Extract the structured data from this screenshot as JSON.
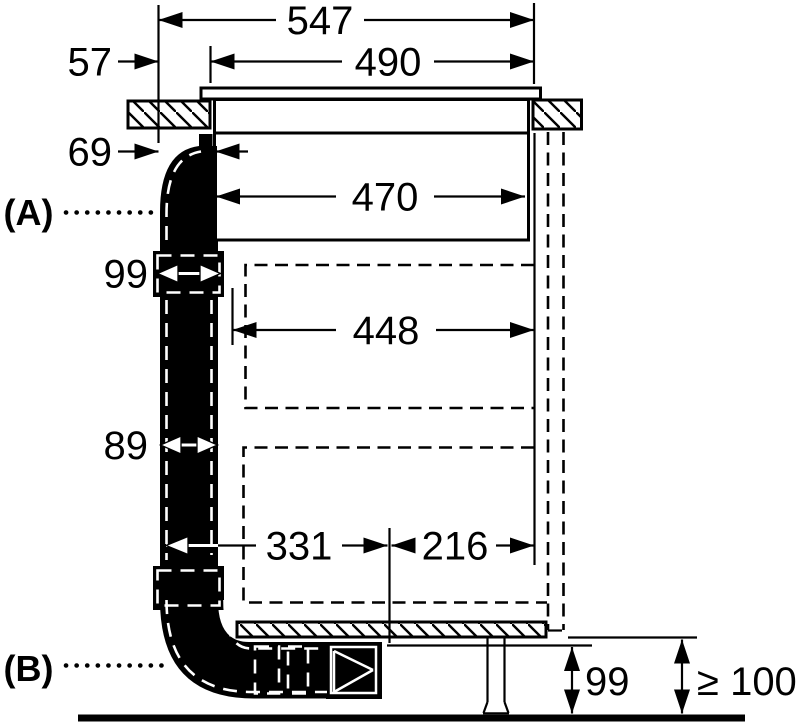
{
  "diagram": {
    "type": "appliance-installation-drawing",
    "description": "Side section view of a venting hob installed in a worktop with downdraft duct routing; all dimensions in mm",
    "colors": {
      "ink": "#000000",
      "paper": "#ffffff"
    },
    "section_labels": {
      "a": "(A)",
      "b": "(B)"
    },
    "dimensions": {
      "total_depth": "547",
      "cutout_depth": "490",
      "front_offset": "57",
      "duct_connector_offset": "69",
      "hob_body_depth": "470",
      "duct_section_top": "99",
      "cabinet_inner_depth": "448",
      "duct_section_mid": "89",
      "duct_run_horizontal": "331",
      "rear_clearance": "216",
      "plinth_duct_height": "99",
      "plinth_min_height": "≥ 100"
    }
  }
}
